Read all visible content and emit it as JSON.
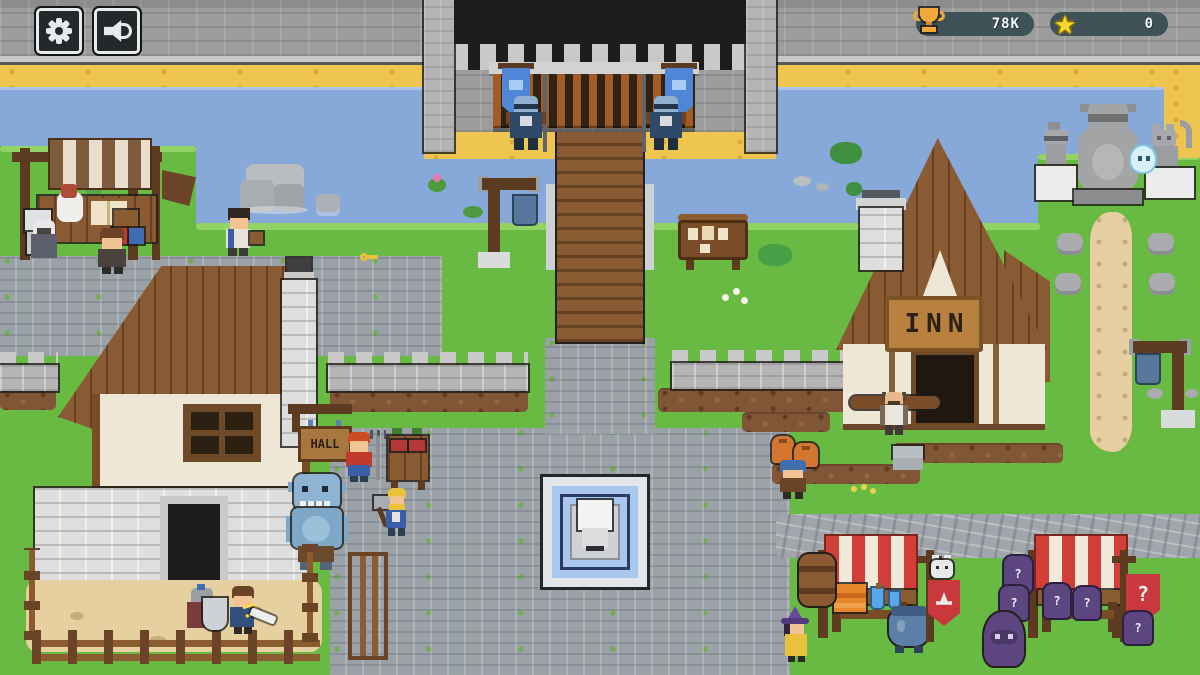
{
  "hud": {
    "trophy_value": "78K",
    "star_value": "0",
    "star_glyph": "★"
  },
  "signs": {
    "hall": "HALL",
    "inn": "INN"
  },
  "market": {
    "question_mark": "?"
  },
  "colors": {
    "grass": "#69ba43",
    "river": "#87a9da",
    "sand": "#eec64f",
    "wall_grey": "#9c9c9c",
    "cobble": "#9aa1a7",
    "wood": "#8a5a32",
    "awning_red": "#d23f38",
    "awning_brown": "#7d5b3c",
    "hud_bar": "#3d5156",
    "trophy_gold": "#f2a93b",
    "star_gold": "#f5d92e",
    "banner_blue": "#4f86d8",
    "mystery_purple": "#5d4680"
  }
}
